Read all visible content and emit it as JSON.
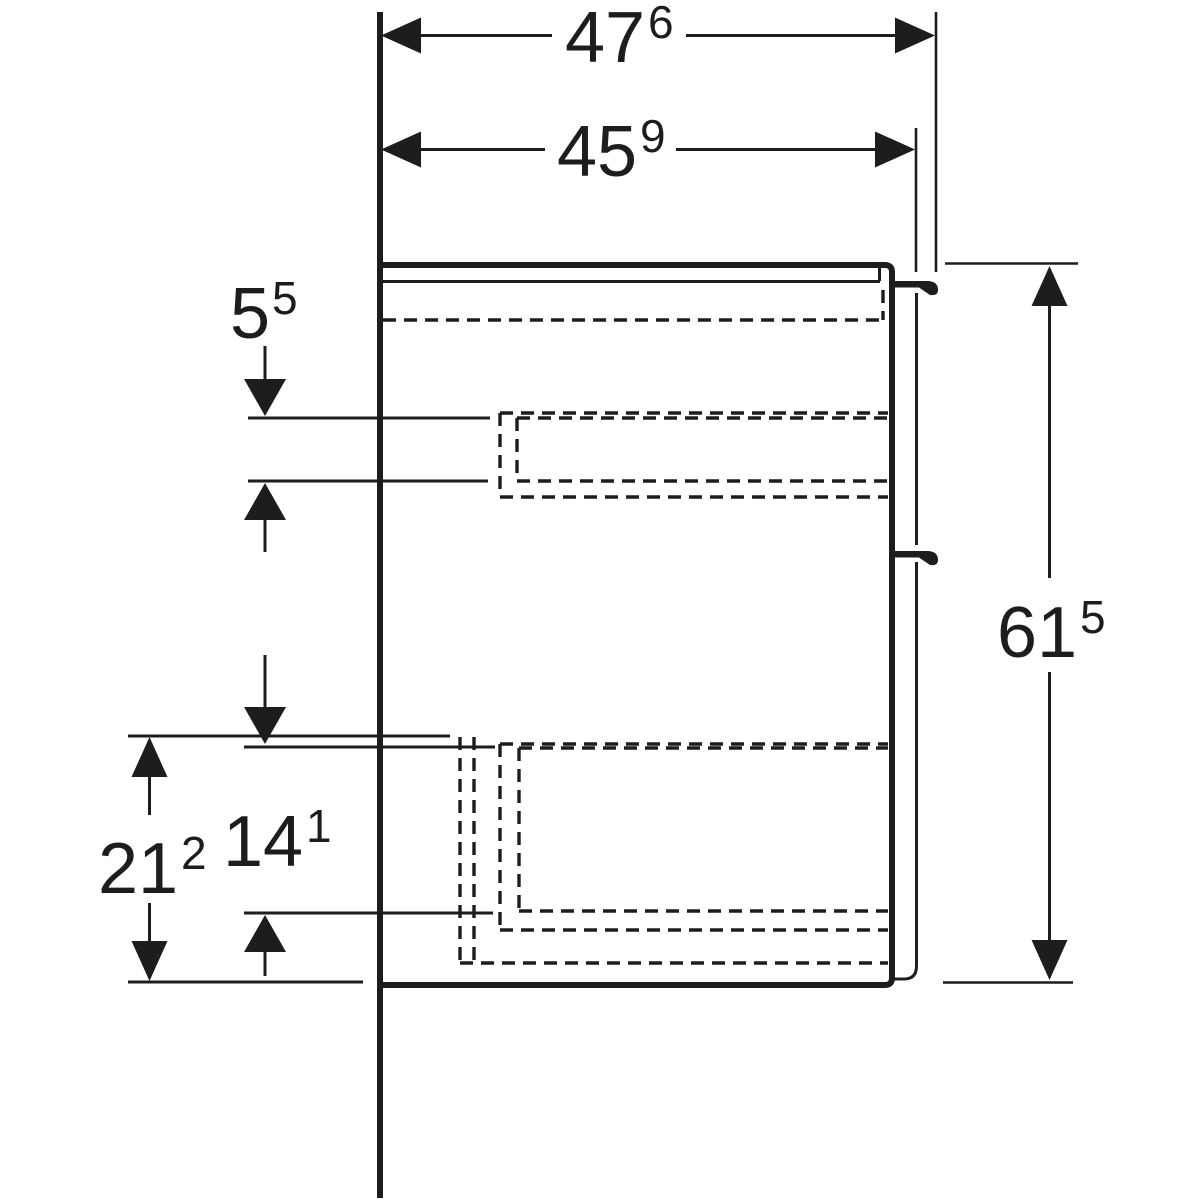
{
  "drawing": {
    "type": "furniture-side-view-dimension-drawing",
    "colors": {
      "ink": "#1d1d1b",
      "background": "#ffffff"
    },
    "dimensions": {
      "overall_depth_with_handle": {
        "value": "47",
        "sup": "6"
      },
      "depth_to_door_front": {
        "value": "45",
        "sup": "9"
      },
      "cabinet_height": {
        "value": "61",
        "sup": "5"
      },
      "upper_drawer_inner_height": {
        "value": "5",
        "sup": "5"
      },
      "lower_drawer_inner_height": {
        "value": "14",
        "sup": "1"
      },
      "lower_compartment_height": {
        "value": "21",
        "sup": "2"
      }
    }
  }
}
